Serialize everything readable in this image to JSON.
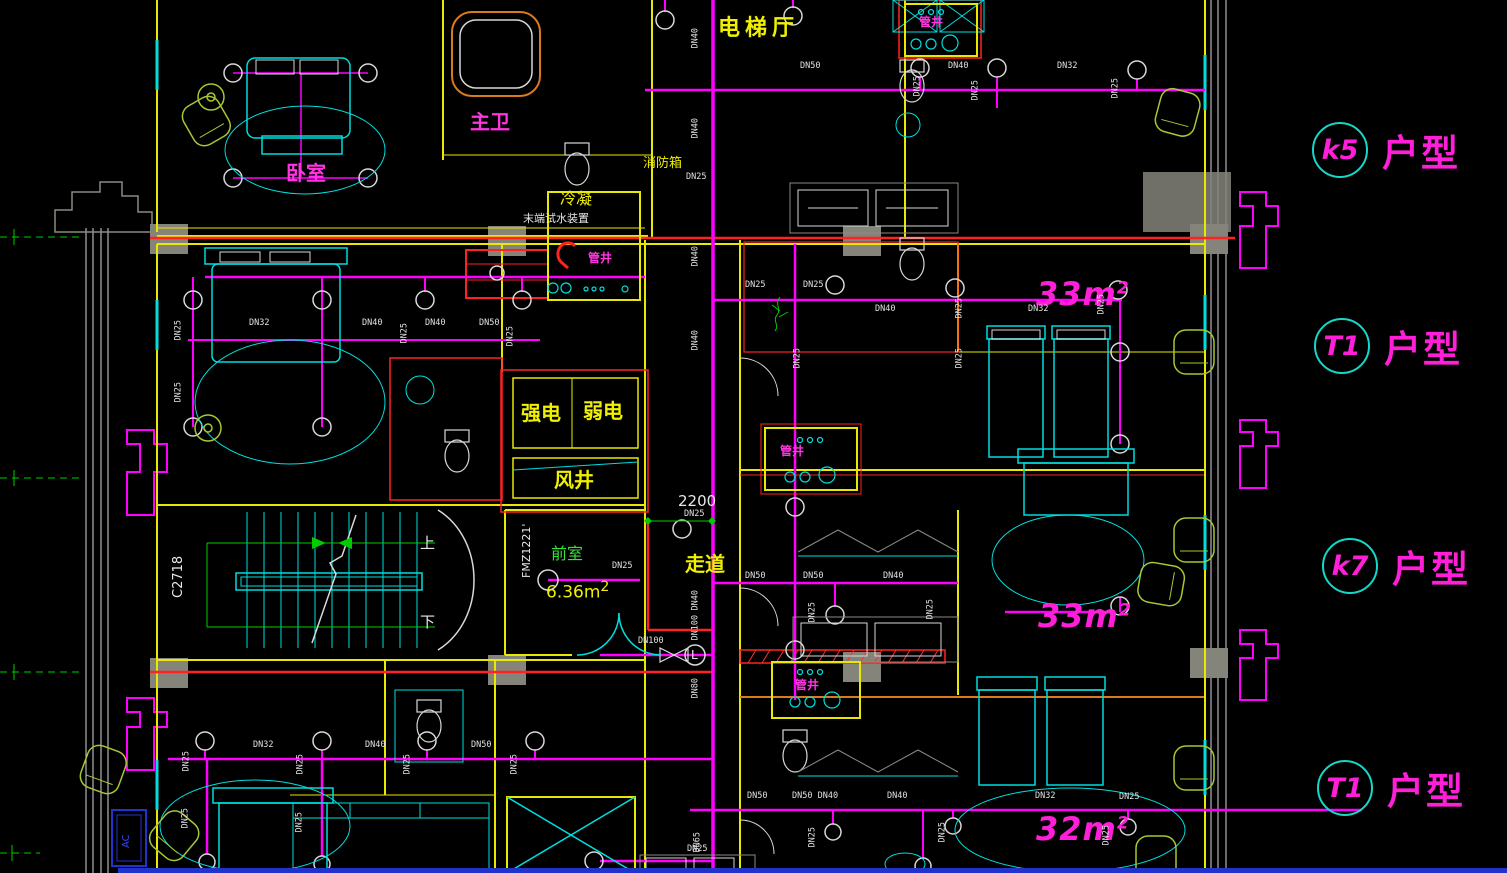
{
  "palette": {
    "background": "#000000",
    "wall_yellow": "#e8e800",
    "fixture_cyan": "#00dede",
    "pipe_magenta": "#ff00ff",
    "fire_red": "#ff2222",
    "furniture_chartreuse": "#a6c832",
    "axis_green": "#00cc00",
    "text_white": "#e2e2e2",
    "accent_orange": "#d97a1d",
    "ac_blue": "#2233cc",
    "unit_tag_magenta": "#ff1fd8",
    "unit_circle_cyan": "#15d8c8"
  },
  "rooms": {
    "elevator_hall": "电梯厅",
    "master_bath": "主卫",
    "bedroom": "卧室",
    "fire_hydrant_box": "消防箱",
    "condensate": "冷凝",
    "end_test_water_device": "末端试水装置",
    "pipe_shaft": "管井",
    "strong_electric": "强电",
    "weak_electric": "弱电",
    "air_shaft": "风井",
    "front_room": "前室",
    "corridor": "走道"
  },
  "annotations": {
    "front_room_area": "6.36m",
    "front_room_area_sup": "2",
    "dimension": "2200",
    "door_code": "FMZ1221'",
    "window_code": "C2718",
    "stair_up": "上",
    "stair_down": "下",
    "ac_unit": "AC",
    "drain_tag": "L"
  },
  "unit_tags": [
    {
      "code": "k5",
      "label": "户型"
    },
    {
      "code": "T1",
      "label": "户型"
    },
    {
      "code": "k7",
      "label": "户型"
    },
    {
      "code": "T1",
      "label": "户型"
    }
  ],
  "area_labels": [
    {
      "value": "33m",
      "sup": "2"
    },
    {
      "value": "33m",
      "sup": "2"
    },
    {
      "value": "32m",
      "sup": "2"
    }
  ],
  "pipe_labels": [
    {
      "t": "DN50",
      "x": 800,
      "y": 62,
      "v": 0
    },
    {
      "t": "DN40",
      "x": 700,
      "y": 40,
      "v": 1
    },
    {
      "t": "DN40",
      "x": 700,
      "y": 130,
      "v": 1
    },
    {
      "t": "DN40",
      "x": 948,
      "y": 62,
      "v": 0
    },
    {
      "t": "DN25",
      "x": 922,
      "y": 88,
      "v": 1
    },
    {
      "t": "DN25",
      "x": 980,
      "y": 92,
      "v": 1
    },
    {
      "t": "DN32",
      "x": 1057,
      "y": 62,
      "v": 0
    },
    {
      "t": "DN25",
      "x": 1120,
      "y": 90,
      "v": 1
    },
    {
      "t": "DN25",
      "x": 686,
      "y": 173,
      "v": 0
    },
    {
      "t": "DN40",
      "x": 700,
      "y": 258,
      "v": 1
    },
    {
      "t": "DN25",
      "x": 745,
      "y": 281,
      "v": 0
    },
    {
      "t": "DN25",
      "x": 803,
      "y": 281,
      "v": 0
    },
    {
      "t": "DN40",
      "x": 875,
      "y": 305,
      "v": 0
    },
    {
      "t": "DN25",
      "x": 964,
      "y": 310,
      "v": 1
    },
    {
      "t": "DN25",
      "x": 802,
      "y": 360,
      "v": 1
    },
    {
      "t": "DN25",
      "x": 964,
      "y": 360,
      "v": 1
    },
    {
      "t": "DN32",
      "x": 1028,
      "y": 305,
      "v": 0
    },
    {
      "t": "DN25",
      "x": 1106,
      "y": 306,
      "v": 1
    },
    {
      "t": "DN25",
      "x": 183,
      "y": 332,
      "v": 1
    },
    {
      "t": "DN25",
      "x": 183,
      "y": 394,
      "v": 1
    },
    {
      "t": "DN32",
      "x": 249,
      "y": 319,
      "v": 0
    },
    {
      "t": "DN40",
      "x": 362,
      "y": 319,
      "v": 0
    },
    {
      "t": "DN25",
      "x": 409,
      "y": 335,
      "v": 1
    },
    {
      "t": "DN40",
      "x": 425,
      "y": 319,
      "v": 0
    },
    {
      "t": "DN50",
      "x": 479,
      "y": 319,
      "v": 0
    },
    {
      "t": "DN25",
      "x": 515,
      "y": 338,
      "v": 1
    },
    {
      "t": "DN40",
      "x": 700,
      "y": 342,
      "v": 1
    },
    {
      "t": "DN25",
      "x": 684,
      "y": 510,
      "v": 0
    },
    {
      "t": "DN25",
      "x": 612,
      "y": 562,
      "v": 0
    },
    {
      "t": "DN50",
      "x": 745,
      "y": 572,
      "v": 0
    },
    {
      "t": "DN50",
      "x": 803,
      "y": 572,
      "v": 0
    },
    {
      "t": "DN40",
      "x": 883,
      "y": 572,
      "v": 0
    },
    {
      "t": "DN25",
      "x": 817,
      "y": 614,
      "v": 1
    },
    {
      "t": "DN25",
      "x": 935,
      "y": 611,
      "v": 1
    },
    {
      "t": "DN40",
      "x": 700,
      "y": 602,
      "v": 1
    },
    {
      "t": "DN100",
      "x": 700,
      "y": 632,
      "v": 1
    },
    {
      "t": "DN100",
      "x": 638,
      "y": 637,
      "v": 0
    },
    {
      "t": "DN80",
      "x": 700,
      "y": 690,
      "v": 1
    },
    {
      "t": "DN25",
      "x": 191,
      "y": 763,
      "v": 1
    },
    {
      "t": "DN32",
      "x": 253,
      "y": 741,
      "v": 0
    },
    {
      "t": "DN25",
      "x": 305,
      "y": 766,
      "v": 1
    },
    {
      "t": "DN40",
      "x": 365,
      "y": 741,
      "v": 0
    },
    {
      "t": "DN25",
      "x": 412,
      "y": 766,
      "v": 1
    },
    {
      "t": "DN50",
      "x": 471,
      "y": 741,
      "v": 0
    },
    {
      "t": "DN25",
      "x": 519,
      "y": 766,
      "v": 1
    },
    {
      "t": "DN25",
      "x": 190,
      "y": 820,
      "v": 1
    },
    {
      "t": "DN25",
      "x": 304,
      "y": 824,
      "v": 1
    },
    {
      "t": "DN50",
      "x": 747,
      "y": 792,
      "v": 0
    },
    {
      "t": "DN50 DN40",
      "x": 792,
      "y": 792,
      "v": 0
    },
    {
      "t": "DN40",
      "x": 887,
      "y": 792,
      "v": 0
    },
    {
      "t": "DN32",
      "x": 1035,
      "y": 792,
      "v": 0
    },
    {
      "t": "DN25",
      "x": 1119,
      "y": 793,
      "v": 0
    },
    {
      "t": "DN25",
      "x": 817,
      "y": 839,
      "v": 1
    },
    {
      "t": "DN25",
      "x": 947,
      "y": 834,
      "v": 1
    },
    {
      "t": "DN25",
      "x": 1111,
      "y": 837,
      "v": 1
    },
    {
      "t": "DN65",
      "x": 702,
      "y": 844,
      "v": 1
    },
    {
      "t": "DN25",
      "x": 687,
      "y": 845,
      "v": 0
    }
  ]
}
